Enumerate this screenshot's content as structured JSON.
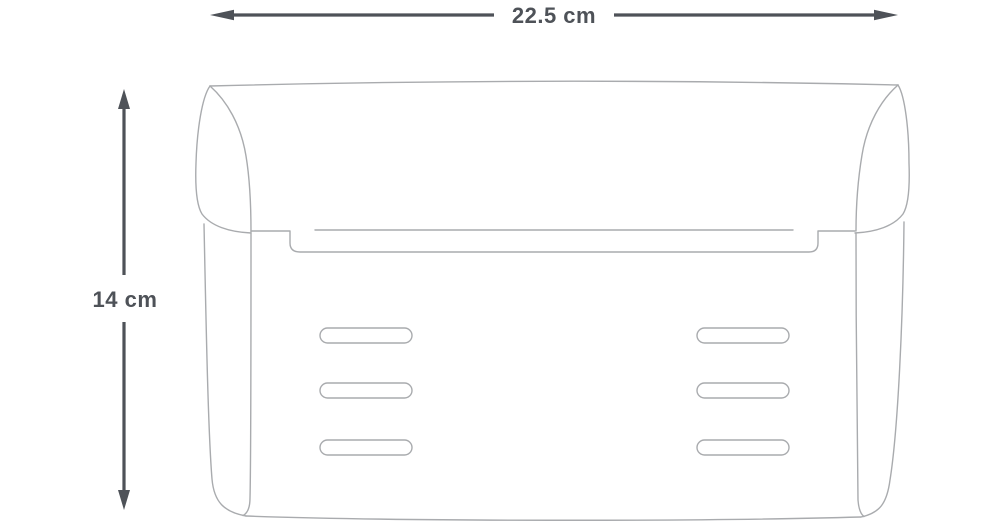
{
  "page": {
    "background": "#ffffff"
  },
  "diagram": {
    "type": "product-dimension-line-drawing",
    "subject": "flap-bag-front-view-outline",
    "width_label": "22.5 cm",
    "height_label": "14 cm",
    "colors": {
      "dimension": "#4e5258",
      "outline": "#a9abae",
      "background": "#ffffff"
    }
  }
}
